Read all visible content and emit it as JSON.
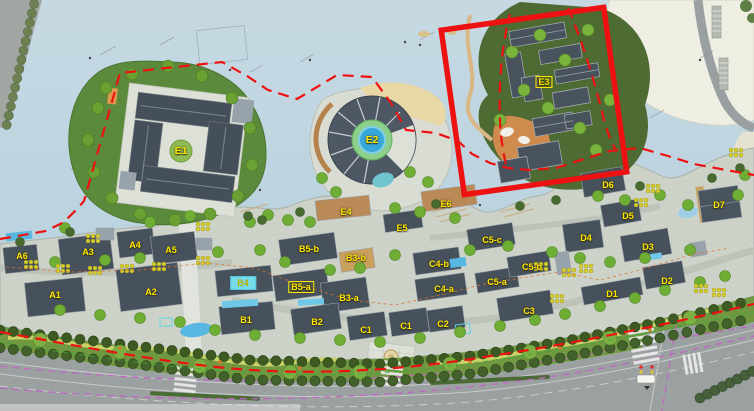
{
  "map": {
    "type": "resort-town-master-plan",
    "label_color": "#ffe600",
    "labels": [
      {
        "id": "e1",
        "text": "E1",
        "x": 181,
        "y": 151,
        "variant": "lg"
      },
      {
        "id": "e2",
        "text": "E2",
        "x": 372,
        "y": 140,
        "variant": "lg"
      },
      {
        "id": "e3",
        "text": "E3",
        "x": 544,
        "y": 82,
        "variant": "box"
      },
      {
        "id": "e4",
        "text": "E4",
        "x": 346,
        "y": 212,
        "variant": "plain"
      },
      {
        "id": "e5",
        "text": "E5",
        "x": 402,
        "y": 228,
        "variant": "plain"
      },
      {
        "id": "e6",
        "text": "E6",
        "x": 446,
        "y": 204,
        "variant": "plain"
      },
      {
        "id": "a6",
        "text": "A6",
        "x": 22,
        "y": 256,
        "variant": "plain"
      },
      {
        "id": "a3",
        "text": "A3",
        "x": 88,
        "y": 252,
        "variant": "plain"
      },
      {
        "id": "a4",
        "text": "A4",
        "x": 135,
        "y": 245,
        "variant": "plain"
      },
      {
        "id": "a5",
        "text": "A5",
        "x": 171,
        "y": 250,
        "variant": "plain"
      },
      {
        "id": "a1",
        "text": "A1",
        "x": 55,
        "y": 295,
        "variant": "plain"
      },
      {
        "id": "a2",
        "text": "A2",
        "x": 151,
        "y": 292,
        "variant": "plain"
      },
      {
        "id": "b5-b",
        "text": "B5-b",
        "x": 309,
        "y": 249,
        "variant": "plain"
      },
      {
        "id": "b3-b",
        "text": "B3-b",
        "x": 356,
        "y": 258,
        "variant": "plain"
      },
      {
        "id": "b4",
        "text": "B4",
        "x": 243,
        "y": 283,
        "variant": "cyan"
      },
      {
        "id": "b5-a",
        "text": "B5-a",
        "x": 301,
        "y": 287,
        "variant": "box"
      },
      {
        "id": "b3-a",
        "text": "B3-a",
        "x": 349,
        "y": 298,
        "variant": "plain"
      },
      {
        "id": "b1",
        "text": "B1",
        "x": 246,
        "y": 320,
        "variant": "plain"
      },
      {
        "id": "b2",
        "text": "B2",
        "x": 317,
        "y": 322,
        "variant": "plain"
      },
      {
        "id": "c1-west",
        "text": "C1",
        "x": 366,
        "y": 330,
        "variant": "plain"
      },
      {
        "id": "c1-east",
        "text": "C1",
        "x": 406,
        "y": 326,
        "variant": "plain"
      },
      {
        "id": "c2",
        "text": "C2",
        "x": 443,
        "y": 324,
        "variant": "plain"
      },
      {
        "id": "c3",
        "text": "C3",
        "x": 529,
        "y": 311,
        "variant": "plain"
      },
      {
        "id": "c4-b",
        "text": "C4-b",
        "x": 439,
        "y": 264,
        "variant": "plain"
      },
      {
        "id": "c4-a",
        "text": "C4-a",
        "x": 444,
        "y": 289,
        "variant": "plain"
      },
      {
        "id": "c5-c",
        "text": "C5-c",
        "x": 492,
        "y": 240,
        "variant": "plain"
      },
      {
        "id": "c5-b",
        "text": "C5-b",
        "x": 532,
        "y": 267,
        "variant": "plain"
      },
      {
        "id": "c5-a",
        "text": "C5-a",
        "x": 497,
        "y": 282,
        "variant": "plain"
      },
      {
        "id": "d1",
        "text": "D1",
        "x": 612,
        "y": 294,
        "variant": "plain"
      },
      {
        "id": "d2",
        "text": "D2",
        "x": 667,
        "y": 281,
        "variant": "plain"
      },
      {
        "id": "d3",
        "text": "D3",
        "x": 648,
        "y": 247,
        "variant": "plain"
      },
      {
        "id": "d4",
        "text": "D4",
        "x": 586,
        "y": 238,
        "variant": "plain"
      },
      {
        "id": "d5",
        "text": "D5",
        "x": 628,
        "y": 216,
        "variant": "plain"
      },
      {
        "id": "d6",
        "text": "D6",
        "x": 608,
        "y": 185,
        "variant": "plain"
      },
      {
        "id": "d7",
        "text": "D7",
        "x": 719,
        "y": 205,
        "variant": "plain"
      }
    ],
    "annotations": {
      "selection_box": {
        "shape": "rectangle",
        "color": "#ee1111"
      },
      "site_boundary": {
        "style": "dashed",
        "color": "#ee1111"
      }
    },
    "colors": {
      "water": "#bdd5e2",
      "paving": "#ccd2c8",
      "roof": "#47515b",
      "brown_roof": "#b98a56",
      "tree": "#6fae35",
      "buffer_green": "#6f9840",
      "road": "#9ba0a0",
      "pool": "#38a8dc",
      "plaza_orange": "#cf8a4d",
      "open_land": "#efeee2",
      "metro_line": "#c463c8"
    }
  }
}
